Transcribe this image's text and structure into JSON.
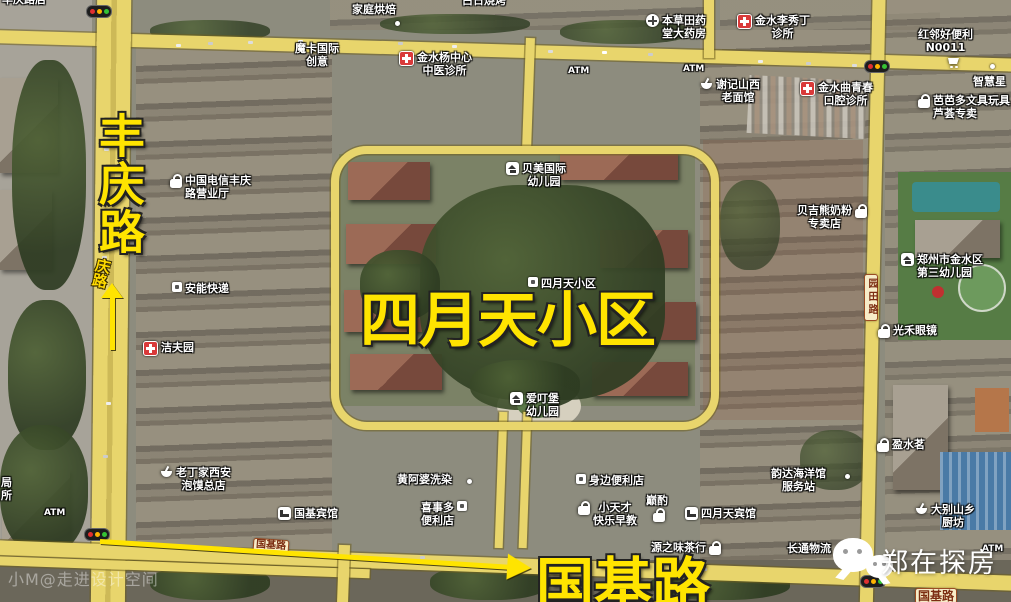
{
  "big_labels": {
    "fengqing_road": "丰庆路",
    "siyuetian_community": "四月天小区",
    "guoji_road": "国基路"
  },
  "road_badges": {
    "qinglu": "庆路",
    "yuantian_road": "园田路",
    "guoji_small": "国基路",
    "guoji_corner": "国基路"
  },
  "pois": {
    "topleft_partial": {
      "line1": "丰庆路店"
    },
    "top_partial": {
      "line1": "白日烧烤"
    },
    "jiating_baking": {
      "line1": "家庭烘焙"
    },
    "moka_international": {
      "line1": "魔卡国际",
      "line2": "创意"
    },
    "jinshuiyang_clinic": {
      "line1": "金水杨中心",
      "line2": "中医诊所"
    },
    "atm_1": {
      "line1": "ATM"
    },
    "atm_2": {
      "line1": "ATM"
    },
    "bencao_pharmacy": {
      "line1": "本草田药",
      "line2": "堂大药房"
    },
    "jinshui_lixiuding": {
      "line1": "金水李秀丁",
      "line2": "诊所"
    },
    "honglin_store": {
      "line1": "红邻好便利",
      "line2": "N0011"
    },
    "xieji_noodle": {
      "line1": "谢记山西",
      "line2": "老面馆"
    },
    "jinshui_dental": {
      "line1": "金水曲青春",
      "line2": "口腔诊所"
    },
    "zhihuixing": {
      "line1": "智慧星"
    },
    "babaduo": {
      "line1": "芭芭多文具玩具",
      "line2": "芦荟专卖"
    },
    "telecom": {
      "line1": "中国电信丰庆",
      "line2": "路营业厅"
    },
    "anneng_express": {
      "line1": "安能快递"
    },
    "jiefuyuan": {
      "line1": "洁夫园"
    },
    "beimei_kindergarten": {
      "line1": "贝美国际",
      "line2": "幼儿园"
    },
    "siyuetian_small": {
      "line1": "四月天小区"
    },
    "beijixiong_milk": {
      "line1": "贝吉熊奶粉",
      "line2": "专卖店"
    },
    "third_kindergarten": {
      "line1": "郑州市金水区",
      "line2": "第三幼儿园"
    },
    "guanghe_glasses": {
      "line1": "光禾眼镜"
    },
    "laodingjia": {
      "line1": "老丁家西安",
      "line2": "泡馍总店"
    },
    "left_partial": {
      "line1": "局",
      "line2": "所"
    },
    "atm_3": {
      "line1": "ATM"
    },
    "guoji_hotel": {
      "line1": "国基宾馆"
    },
    "huangapo": {
      "line1": "黄阿婆洗染"
    },
    "xishiduo": {
      "line1": "喜事多",
      "line2": "便利店"
    },
    "aidingbao": {
      "line1": "爱叮堡",
      "line2": "幼儿园"
    },
    "shenbian_store": {
      "line1": "身边便利店"
    },
    "xiaotiancai": {
      "line1": "小天才",
      "line2": "快乐早教"
    },
    "dianzhuo": {
      "line1": "巅酌"
    },
    "siyuetian_hotel": {
      "line1": "四月天宾馆"
    },
    "yunda_ocean": {
      "line1": "韵达海洋馆",
      "line2": "服务站"
    },
    "yuanzhiwei": {
      "line1": "源之味茶行"
    },
    "changtong_logistics": {
      "line1": "长通物流"
    },
    "yingshuiming": {
      "line1": "盈水茗"
    },
    "dabieshan": {
      "line1": "大别山乡",
      "line2": "厨坊"
    },
    "atm_4": {
      "line1": "ATM"
    }
  },
  "watermarks": {
    "wechat_account": "郑在探房",
    "designer": "小M@走进设计空间"
  }
}
